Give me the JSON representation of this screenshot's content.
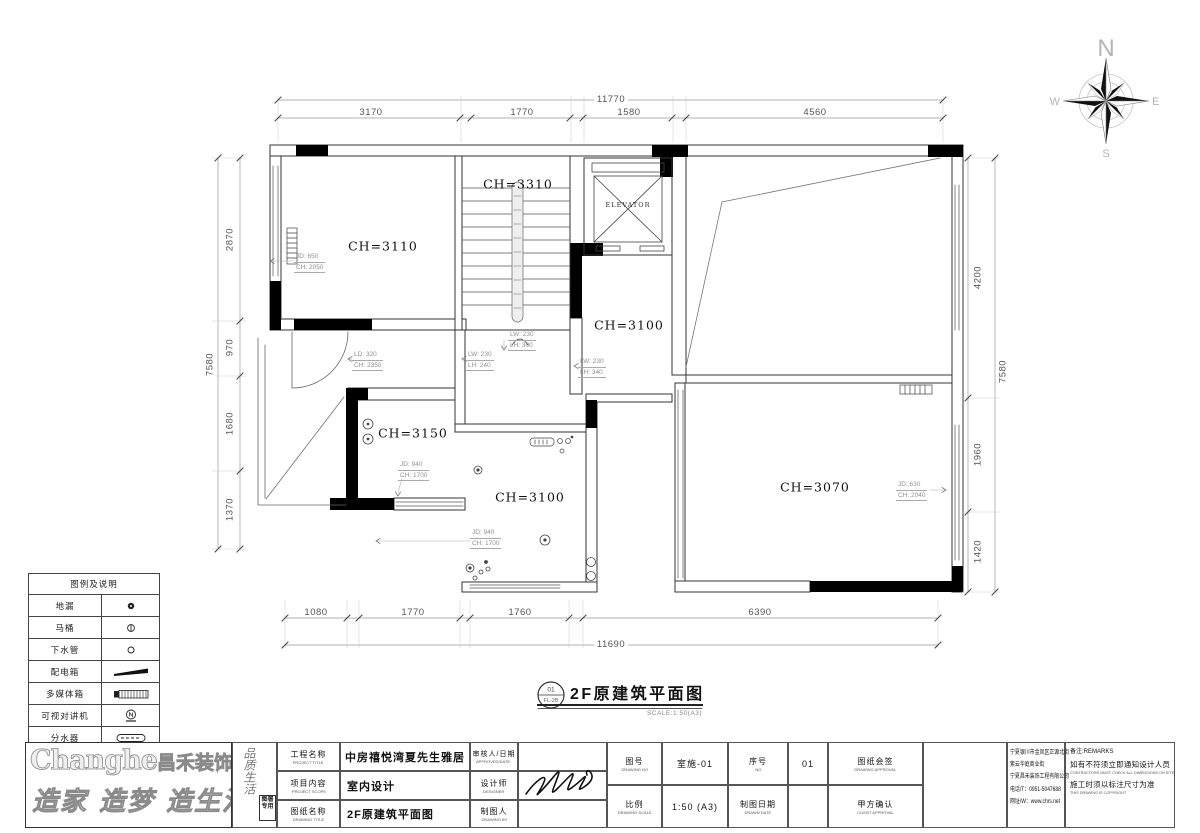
{
  "compass": {
    "north": "N",
    "east": "E",
    "south": "S",
    "west": "W"
  },
  "rooms": {
    "r1": "CH=3110",
    "stair": "CH=3310",
    "elevator": "ELEVATOR",
    "mid": "CH=3100",
    "r3150": "CH=3150",
    "bath": "CH=3100",
    "master": "CH=3070"
  },
  "dims": {
    "top_overall": "11770",
    "top_segs": [
      "3170",
      "1770",
      "1580",
      "4560"
    ],
    "bottom_overall": "11690",
    "bottom_segs": [
      "1080",
      "1770",
      "1760",
      "6390"
    ],
    "left_overall": "7580",
    "left_segs": [
      "2870",
      "970",
      "1680",
      "1370"
    ],
    "right_overall": "7580",
    "right_segs": [
      "4200",
      "1960",
      "1420"
    ]
  },
  "annos": {
    "a1": {
      "l1": "JD: 650",
      "l2": "CH: 2050"
    },
    "a2": {
      "l1": "LD: 320",
      "l2": "CH: 2350"
    },
    "a3": {
      "l1": "LW: 230",
      "l2": "LH: 240"
    },
    "a4": {
      "l1": "LW: 230",
      "l2": "LH: 300"
    },
    "a5": {
      "l1": "LW: 230",
      "l2": "LH: 340"
    },
    "a6": {
      "l1": "JD: 940",
      "l2": "CH: 1700"
    },
    "a7": {
      "l1": "JD: 940",
      "l2": "CH: 1700"
    },
    "a8": {
      "l1": "JD: 630",
      "l2": "CH: 2040"
    }
  },
  "drawing_title": {
    "num": "01",
    "sheet": "FL-2B",
    "title": "2F原建筑平面图",
    "scale": "SCALE:1:50(A3)"
  },
  "legend": {
    "header": "图例及说明",
    "items": [
      {
        "label": "地漏",
        "icon": "floor-drain-icon"
      },
      {
        "label": "马桶",
        "icon": "toilet-icon"
      },
      {
        "label": "下水管",
        "icon": "drain-pipe-icon"
      },
      {
        "label": "配电箱",
        "icon": "power-box-icon"
      },
      {
        "label": "多媒体箱",
        "icon": "media-box-icon"
      },
      {
        "label": "可视对讲机",
        "icon": "intercom-icon"
      },
      {
        "label": "分水器",
        "icon": "manifold-icon"
      }
    ]
  },
  "logo": {
    "brand_en": "Changhe",
    "brand_cn": "昌禾装饰",
    "slogan": "造家 造梦 造生活",
    "side_text": "品质生活",
    "stamp": "图署专用"
  },
  "title_block": {
    "project_cn": "工程名称",
    "project_en": "PROJECT TITLE",
    "project_value": "中房禧悦湾夏先生雅居",
    "scope_cn": "项目内容",
    "scope_en": "PROJECT SCOPE",
    "scope_value": "室内设计",
    "drawing_cn": "图纸名称",
    "drawing_en": "DRAWING TITLE",
    "drawing_value": "2F原建筑平面图",
    "approved_cn": "审核人/日期",
    "approved_en": "APPROVED/DATE:",
    "designer_cn": "设计师",
    "designer_en": "DESIGNER",
    "drawnby_cn": "制图人",
    "drawnby_en": "DRAWING BY",
    "no_cn": "图号",
    "no_en": "DRAWING NO",
    "no_value": "室施-01",
    "scale_cn": "比例",
    "scale_en": "DRAWING SCALE",
    "scale_value": "1:50 (A3)",
    "seq_cn": "序号",
    "seq_en": "NO",
    "seq_value": "01",
    "date_cn": "制图日期",
    "date_en": "DRAWN DATE",
    "approval_cn": "图纸会签",
    "approval_en": "DRAWING APPROVAL",
    "client_cn": "甲方确认",
    "client_en": "CLIENT APPROVAL",
    "company_lines": [
      "宁夏银川市金凤区正源北街",
      "紫云华庭商业街",
      "宁夏昌禾装饰工程有限公司",
      "电话/T：0951-5047688",
      "网址/W：www.chrs.net"
    ],
    "remarks_label": "备注:REMARKS",
    "remark1_cn": "如有不符须立即通知设计人员",
    "remark1_en": "CONTRACTORS MUST CHECK ALL DIMENSIONS ON SITE",
    "remark2_cn": "施工时须以标注尺寸为准",
    "remark2_en": "THIS DRAWING IS COPYRIGHT"
  }
}
